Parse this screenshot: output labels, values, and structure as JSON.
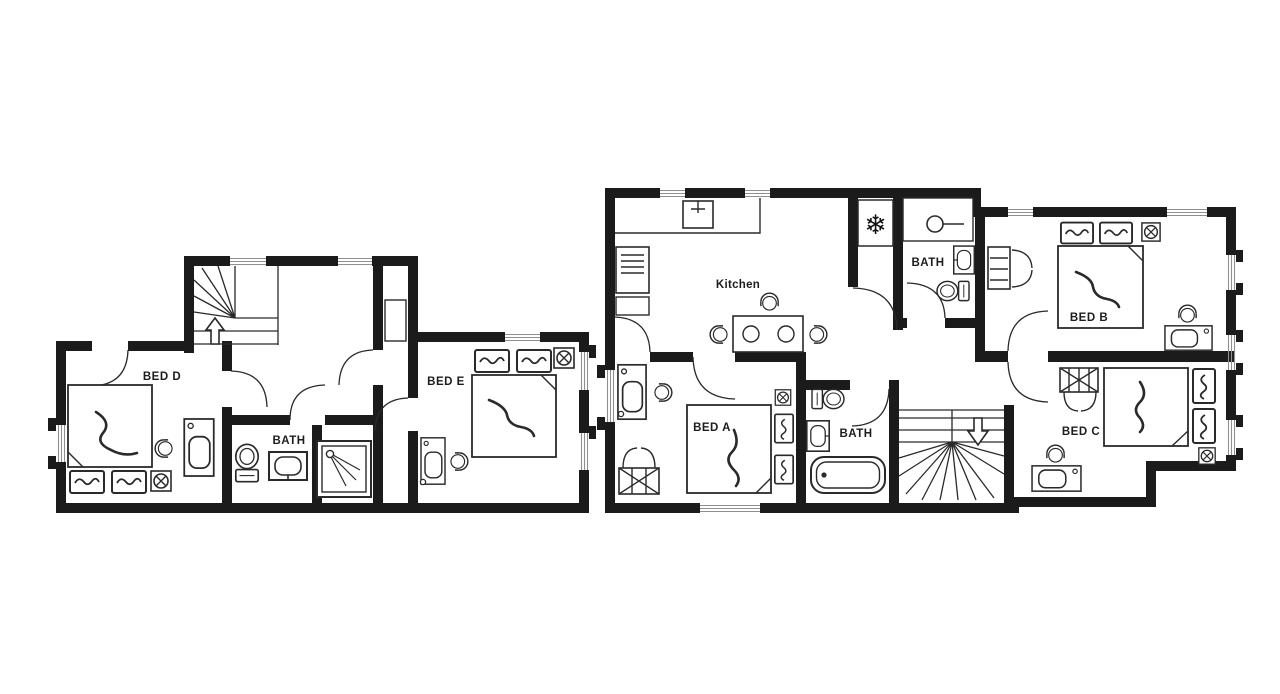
{
  "colors": {
    "wall": "#1b1b1b",
    "line": "#2a2a2a",
    "window": "#8f8f8f",
    "background": "#ffffff"
  },
  "icons": {
    "freezer": "❄"
  },
  "floorplans": [
    {
      "name": "first-floor-plan",
      "rooms": [
        {
          "label": "BED D"
        },
        {
          "label": "BATH"
        },
        {
          "label": "BED E"
        }
      ],
      "features": [
        "staircase-up",
        "toilet",
        "basin",
        "shower",
        "double-bed-x2",
        "desk-chair-x2",
        "cupboard"
      ]
    },
    {
      "name": "ground-floor-plan",
      "rooms": [
        {
          "label": "Kitchen"
        },
        {
          "label": "BATH"
        },
        {
          "label": "BED B"
        },
        {
          "label": "BED A"
        },
        {
          "label": "BATH"
        },
        {
          "label": "BED C"
        }
      ],
      "features": [
        "kitchen-counter",
        "kitchen-sink",
        "cooker",
        "freezer",
        "dining-table-4-chairs",
        "shower",
        "toilet-x2",
        "basin-x3",
        "bathtub",
        "staircase-down",
        "double-bed-x3",
        "desk-chair-x3",
        "wardrobe-x3"
      ]
    }
  ]
}
